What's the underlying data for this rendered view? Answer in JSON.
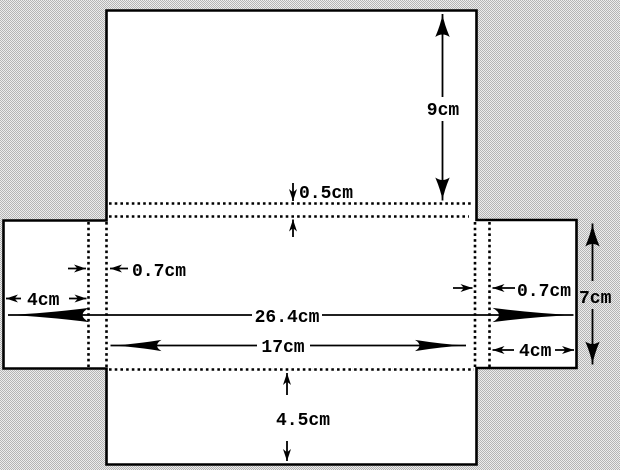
{
  "diagram": {
    "description": "net of an open box / card template with fold allowances, drawn white on a grey halftone background",
    "unit": "cm",
    "colors": {
      "background": "#d1d1d1",
      "background_dot": "#b4b4b4",
      "background_light": "#ececec",
      "shape_fill": "#ffffff",
      "line": "#000000"
    },
    "labels": {
      "top_flap_height": "9cm",
      "fold_strip": "0.5cm",
      "left_fold_width": "0.7cm",
      "left_tab_width": "4cm",
      "total_width": "26.4cm",
      "inner_width": "17cm",
      "right_fold_width": "0.7cm",
      "right_tab_width": "4cm",
      "side_height": "7cm",
      "bottom_flap_height": "4.5cm"
    }
  }
}
